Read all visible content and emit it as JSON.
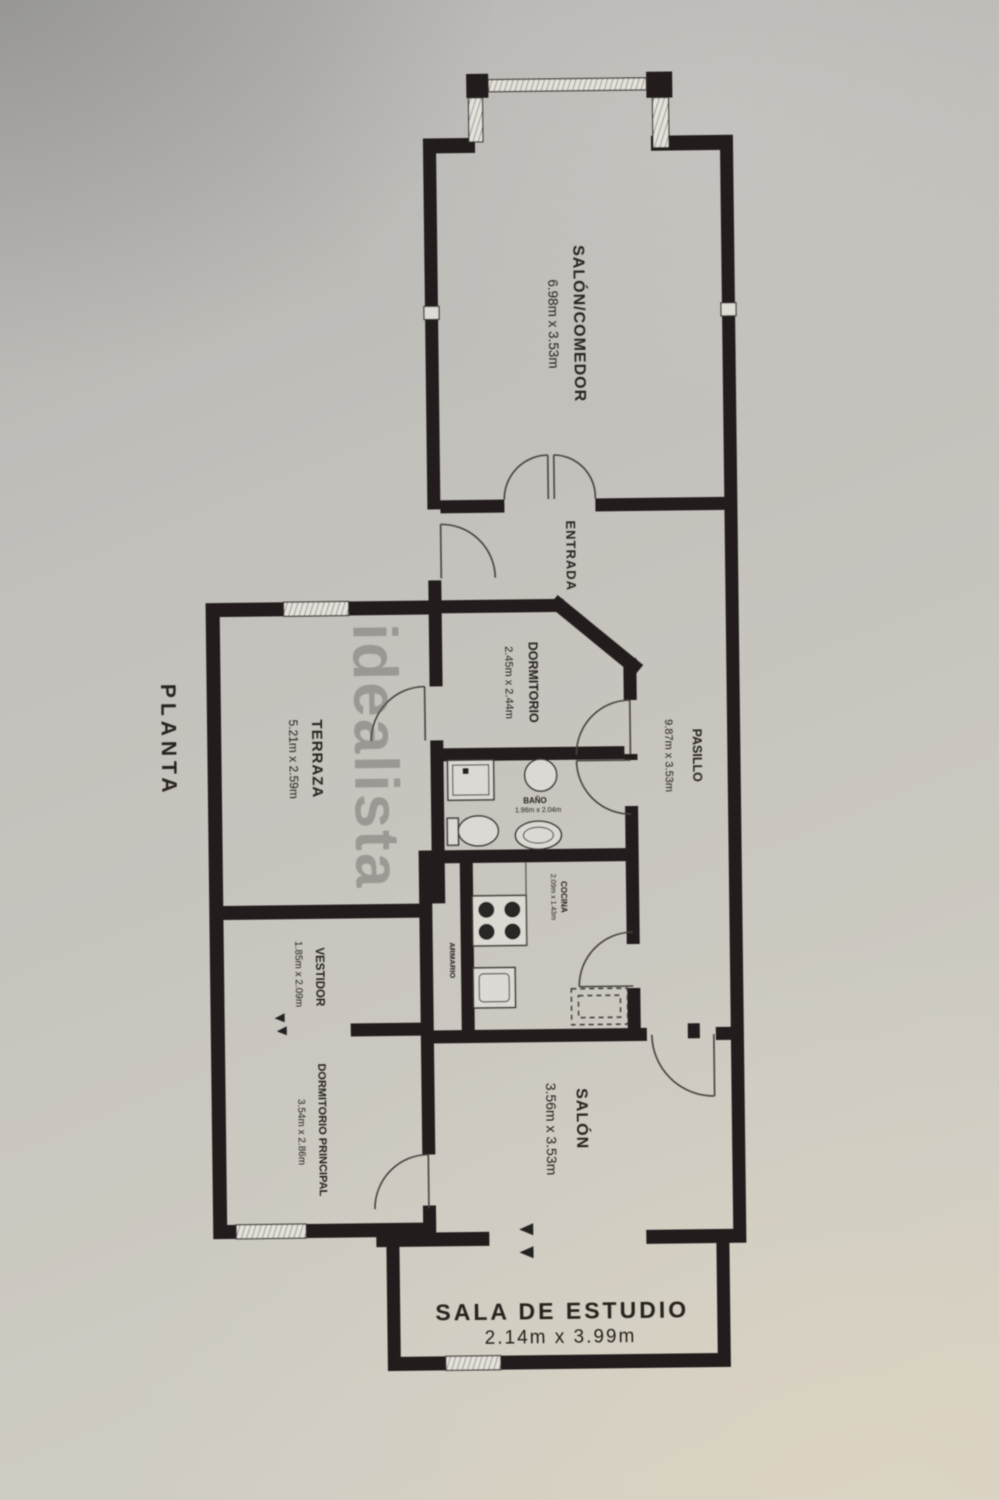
{
  "title": {
    "text": "PLANTA"
  },
  "watermark": {
    "text": "idealista"
  },
  "rooms": {
    "salon_comedor": {
      "name": "SALÓN/COMEDOR",
      "dims": "6.98m x 3.53m"
    },
    "entrada": {
      "name": "ENTRADA"
    },
    "dormitorio": {
      "name": "DORMITORIO",
      "dims": "2.45m x 2.44m"
    },
    "pasillo": {
      "name": "PASILLO",
      "dims": "9.87m x 3.53m"
    },
    "terraza": {
      "name": "TERRAZA",
      "dims": "5.21m x 2.59m"
    },
    "bano": {
      "name": "BAÑO",
      "dims": "1.96m x 2.04m"
    },
    "cocina": {
      "name": "COCINA",
      "dims": "2.09m x 1.43m"
    },
    "armario": {
      "name": "ARMARIO"
    },
    "vestidor": {
      "name": "VESTIDOR",
      "dims": "1.85m x 2.09m"
    },
    "dormitorio_principal": {
      "name": "DORMITORIO PRINCIPAL",
      "dims": "3.54m x 2.86m"
    },
    "salon": {
      "name": "SALÓN",
      "dims": "3.56m x 3.53m"
    },
    "sala_estudio": {
      "name": "SALA DE ESTUDIO",
      "dims": "2.14m x 3.99m"
    }
  },
  "colors": {
    "paper": "#c9c6bf",
    "wall": "#211f1c",
    "line": "#44413c",
    "text": "#26231f",
    "watermark": "#5e5d5b"
  }
}
